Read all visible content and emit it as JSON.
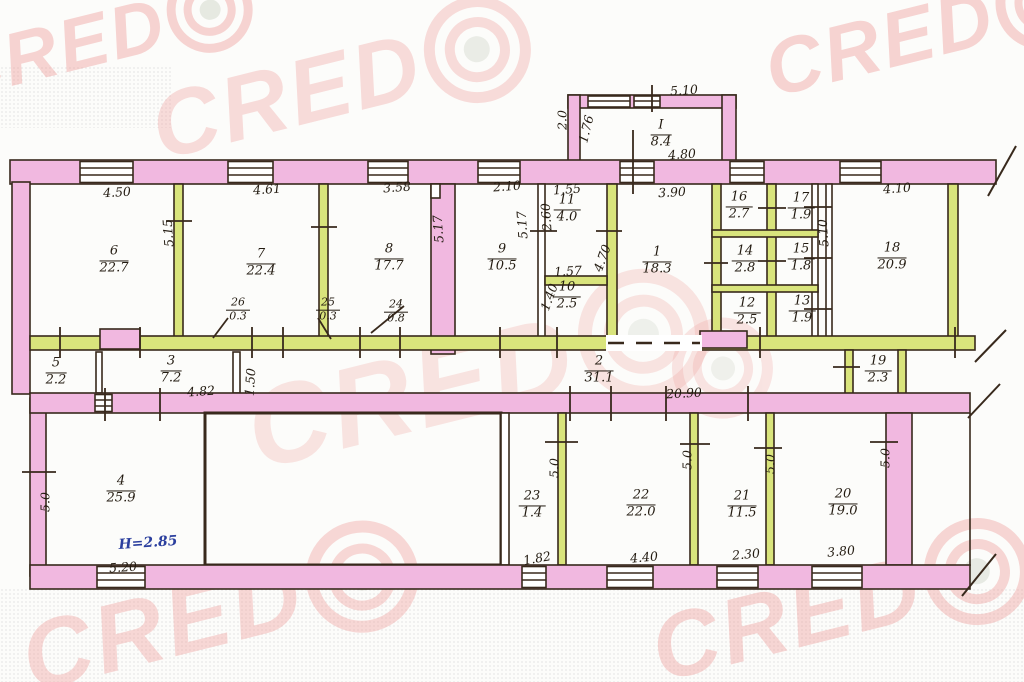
{
  "document": {
    "kind": "scanned floor plan"
  },
  "colors": {
    "wall_pink": "#f1b8e0",
    "partition_green": "#d9e47c",
    "ink": "#38291c",
    "watermark_pink": "#ef9d9a",
    "note_blue": "#2b3f9e"
  },
  "watermark": {
    "letters": "CRED",
    "full_text": "CREDO"
  },
  "note": {
    "text": "H=2.85"
  },
  "rooms": [
    {
      "number": "I",
      "area": "8.4"
    },
    {
      "number": "6",
      "area": "22.7"
    },
    {
      "number": "7",
      "area": "22.4"
    },
    {
      "number": "8",
      "area": "17.7"
    },
    {
      "number": "9",
      "area": "10.5"
    },
    {
      "number": "11",
      "area": "4.0"
    },
    {
      "number": "10",
      "area": "2.5"
    },
    {
      "number": "1",
      "area": "18.3"
    },
    {
      "number": "16",
      "area": "2.7"
    },
    {
      "number": "17",
      "area": "1.9"
    },
    {
      "number": "14",
      "area": "2.8"
    },
    {
      "number": "15",
      "area": "1.8"
    },
    {
      "number": "12",
      "area": "2.5"
    },
    {
      "number": "13",
      "area": "1.9"
    },
    {
      "number": "18",
      "area": "20.9"
    },
    {
      "number": "5",
      "area": "2.2"
    },
    {
      "number": "3",
      "area": "7.2"
    },
    {
      "number": "2",
      "area": "31.1"
    },
    {
      "number": "19",
      "area": "2.3"
    },
    {
      "number": "4",
      "area": "25.9"
    },
    {
      "number": "23",
      "area": "1.4"
    },
    {
      "number": "22",
      "area": "22.0"
    },
    {
      "number": "21",
      "area": "11.5"
    },
    {
      "number": "20",
      "area": "19.0"
    },
    {
      "number": "24",
      "area": "0.8"
    },
    {
      "number": "25",
      "area": "0.3"
    },
    {
      "number": "26",
      "area": "0.3"
    }
  ],
  "dims": [
    "5.10",
    "2.0",
    "1.76",
    "4.80",
    "4.50",
    "4.61",
    "3.58",
    "2.10",
    "1.55",
    "3.90",
    "4.10",
    "5.15",
    "5.17",
    "5.17",
    "2.60",
    "1.57",
    "1.40",
    "4.70",
    "5.10",
    "4.82",
    "1.50",
    "20.90",
    "5.0",
    "5.20",
    "5.0",
    "1.82",
    "4.40",
    "5.0",
    "2.30",
    "5.0",
    "3.80",
    "5.0"
  ]
}
